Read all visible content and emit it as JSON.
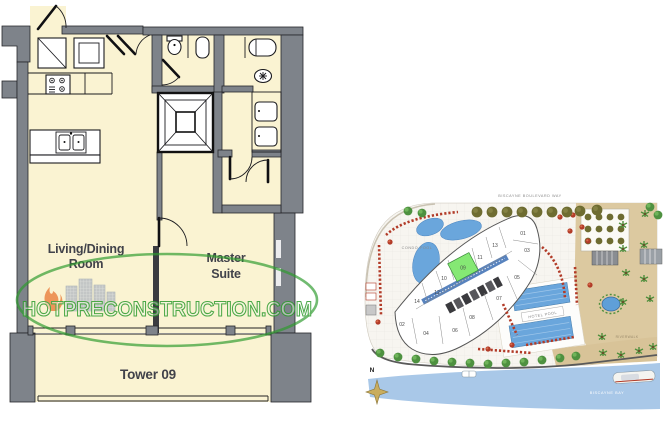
{
  "floorplan": {
    "living_line1": "Living/Dining",
    "living_line2": "Room",
    "master_line1": "Master",
    "master_line2": "Suite",
    "balcony_label": "Tower 09",
    "watermark": "HOTPRECONSTRUCTION.COM"
  },
  "siteplan": {
    "street_label": "BISCAYNE BOULEVARD WAY",
    "condo_pool_label": "CONDO POOL",
    "hotel_pool_label": "HOTEL POOL",
    "bay_label": "BISCAYNE BAY",
    "riverwalk_label": "RIVERWALK",
    "compass_label": "N",
    "highlighted_unit": "09",
    "units": [
      "01",
      "13",
      "03",
      "11",
      "09",
      "05",
      "10",
      "12",
      "07",
      "14",
      "08",
      "02",
      "04",
      "06"
    ]
  },
  "colors": {
    "room_cream": "#FAF3D2",
    "wall_gray": "#7E838A",
    "watermark_green": "#2E9B2E",
    "unit_highlight": "#85E874",
    "water_blue": "#A9C8E8",
    "pool_blue": "#6AA6DC",
    "plaza_tan": "#DCC9A0"
  }
}
